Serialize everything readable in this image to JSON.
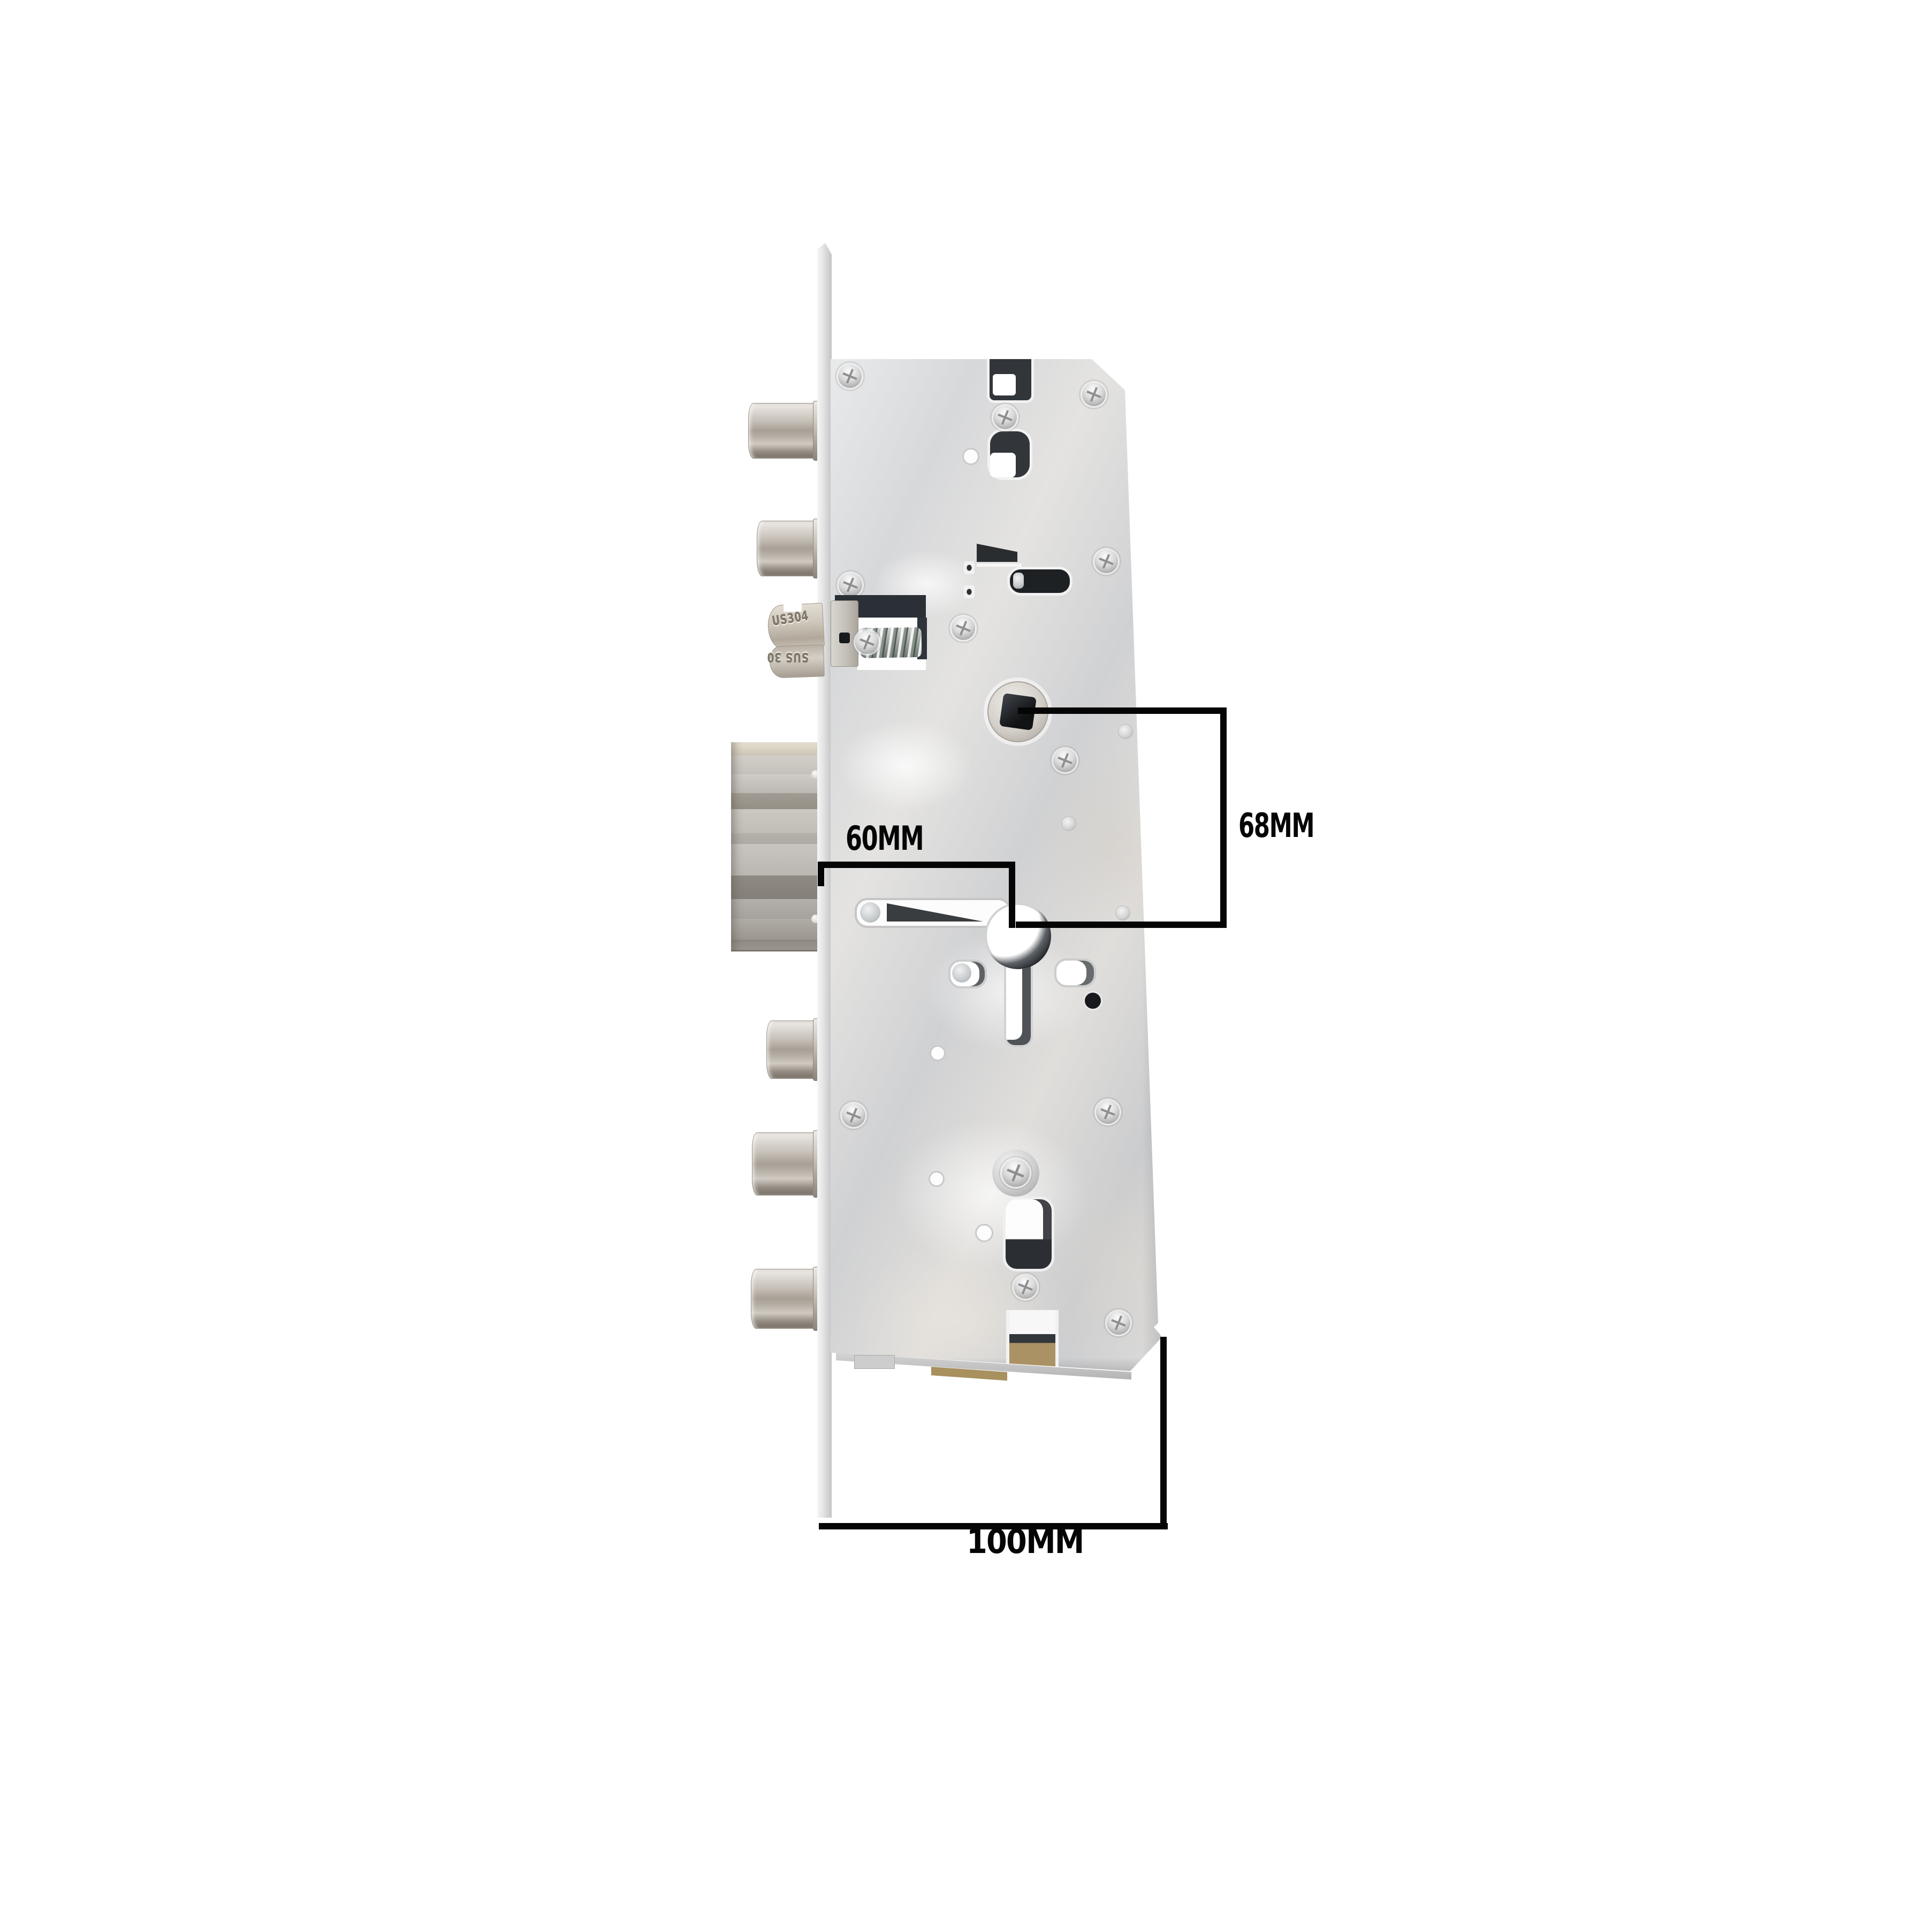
{
  "annotations": {
    "backset": {
      "label": "60MM"
    },
    "center_spacing": {
      "label": "68MM"
    },
    "body_depth": {
      "label": "100MM"
    }
  },
  "engravings": {
    "latch_top": "US304",
    "latch_bottom": "SUS 30"
  },
  "colors": {
    "background": "#ffffff",
    "dimension_lines": "#050505",
    "label_text": "#050505",
    "plate_metal": "#d9dadb",
    "bolt_metal": "#b7b1a9",
    "latch_metal": "#c9c2b7",
    "brass_accent": "#ab9265",
    "hole_interior": "#32363b"
  }
}
